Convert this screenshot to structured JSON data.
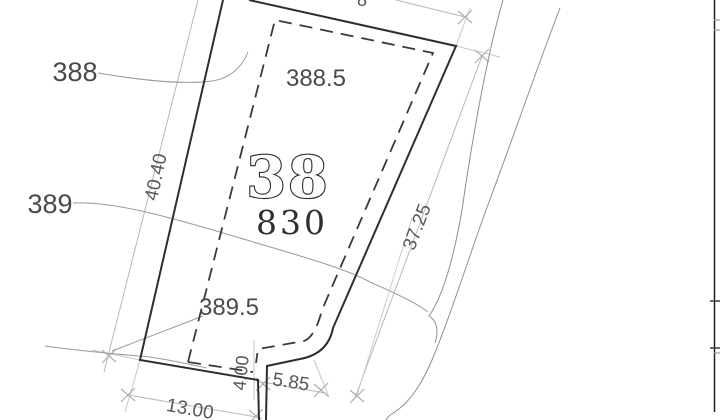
{
  "drawing": {
    "title": "cadastral-site-plan",
    "parcel": {
      "number": "38",
      "area": "830"
    },
    "elevation_labels": {
      "e388": "388",
      "e388_5": "388.5",
      "e389": "389",
      "e389_5": "389.5"
    },
    "dimension_labels": {
      "left_side": "40.40",
      "right_side": "37.25",
      "bottom": "13.00",
      "bottom_right": "5.85",
      "step": "4.00",
      "top_partial": "8"
    },
    "colors": {
      "background": "#ffffff",
      "boundary_line": "#2e2e2e",
      "setback_dashed_line": "#3a3a3a",
      "dimension_line": "#b8b8b8",
      "contour_line": "#9a9a9a",
      "label_text": "#4a4a4a",
      "parcel_text": "#2b2b2b",
      "table_border": "#1f1f1f"
    }
  }
}
